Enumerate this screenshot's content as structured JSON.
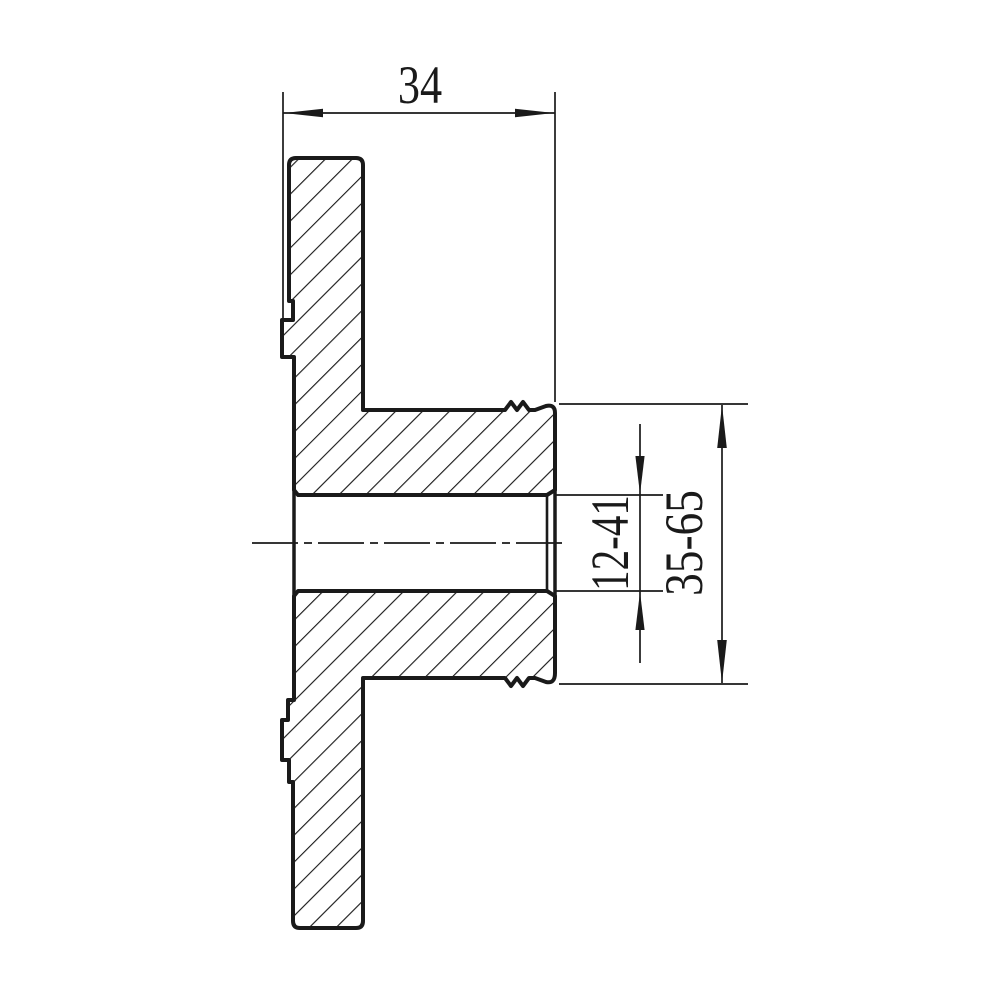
{
  "drawing": {
    "title": "flange-hub-section-view",
    "ink_color": "#1a1a1a",
    "background_color": "#ffffff",
    "labels": {
      "depth": "34",
      "bore_diameter": "12-41",
      "hub_diameter": "35-65"
    }
  }
}
